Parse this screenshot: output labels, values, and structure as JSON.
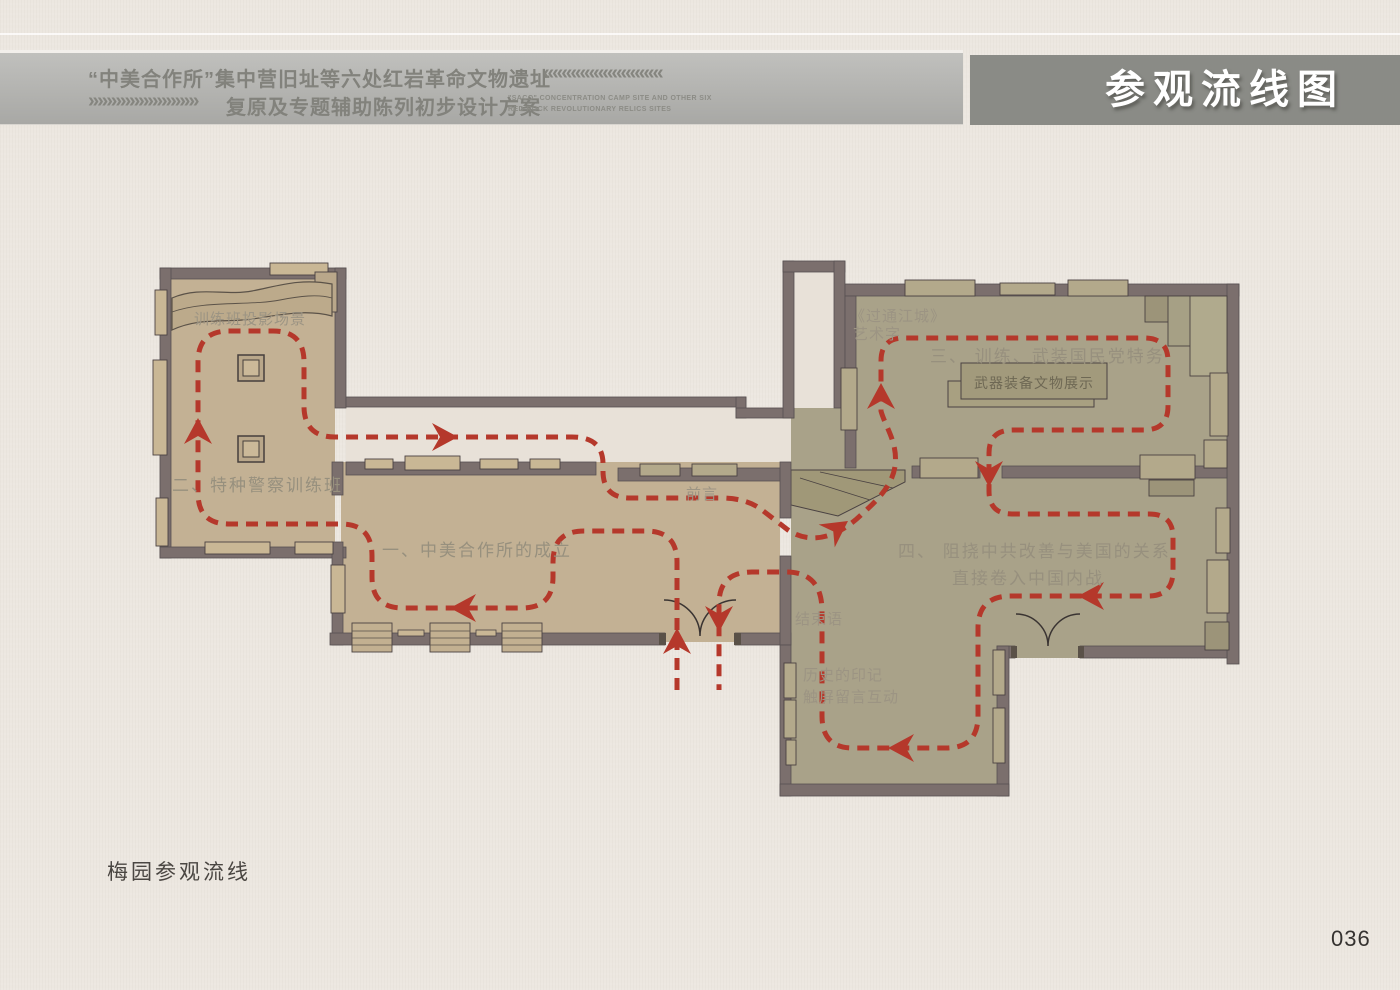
{
  "header": {
    "title_line1": "“中美合作所”集中营旧址等六处红岩革命文物遗址",
    "title_line2": "复原及专题辅助陈列初步设计方案",
    "chevrons_left": "«««««««««««««",
    "chevrons_right": "»»»»»»»»»»»»",
    "subtitle_en_line1": "\"SACO\" CONCENTRATION CAMP SITE AND OTHER SIX",
    "subtitle_en_line2": "RED ROCK REVOLUTIONARY RELICS SITES",
    "page_tag": "参观流线图"
  },
  "caption": "梅园参观流线",
  "page_number": "036",
  "plan": {
    "labels": {
      "room2_feature": "训练班投影场景",
      "room2": "二、特种警察训练班",
      "room1": "一、中美合作所的成立",
      "foreword": "前言",
      "artwork_line1": "《过通江城》",
      "artwork_line2": "艺术字",
      "room3": "三、 训练、武装国民党特务",
      "room3_display": "武器装备文物展示",
      "room4_line1": "四、 阻挠中共改善与美国的关系",
      "room4_line2": "直接卷入中国内战",
      "conclusion": "结束语",
      "interactive_line1": "历史的印记",
      "interactive_line2": "触屏留言互动"
    },
    "colors": {
      "flow_red": "#b5382b",
      "wall": "#7b6f6d",
      "room_tan": "#c3b194",
      "room_olive": "#a9a289",
      "corridor_light": "#e8e1d8",
      "band_gray": "#b3b3b0",
      "title_box_gray": "#8a8b86"
    }
  }
}
